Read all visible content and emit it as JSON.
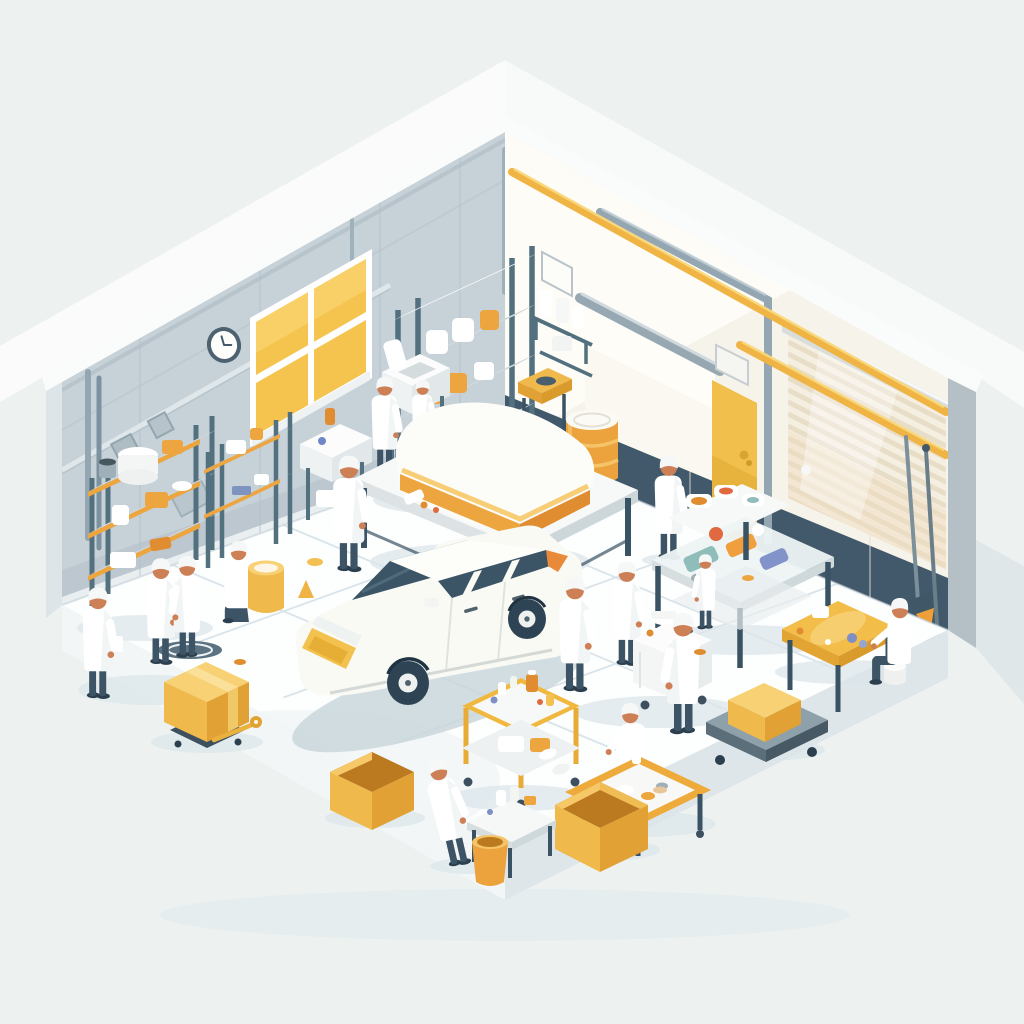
{
  "scene": {
    "description": "Isometric illustration of a bright workshop garage: staff in white coats and caps work around a white station wagon among yellow crates, barrels, part trays, shelving racks and rolling carts",
    "room": {
      "left_wall": "panelled gray-blue wall with round clock, yellow four-pane window, vertical pipes and diamond vents",
      "right_wall": "cream wall with yellow service pipes, yellow personnel door, white roller screen, striped roller shutter, dark teal wainscot and leaning shovels",
      "floor": "white tiled slab on an isometric plinth"
    },
    "objects": [
      "white-station-wagon",
      "left-supply-shelves",
      "tall-storage-rack",
      "wash-station",
      "rinse-counter",
      "orange-barrel",
      "orange-buckets",
      "yellow-drum",
      "closed-yellow-crate",
      "open-part-boxes",
      "tool-cart",
      "tray-table",
      "parts-worktable",
      "yellow-assembly-table",
      "white-service-cart",
      "platform-trolley",
      "jug-shelf",
      "scale-bench",
      "floor-mallet",
      "leaning-shovels",
      "wall-clock",
      "yellow-window"
    ],
    "worker_count": 15
  },
  "palette": {
    "bg": "#edf2f1",
    "glow": "#fbfdfc",
    "wallLeft": "#c7d1d8",
    "wallLeftDark": "#b2bfc8",
    "baseboard": "#e9eef0",
    "capWhite": "#fafcfc",
    "wallRight": "#f5f3ea",
    "wallRightBright": "#fefdf9",
    "wainscot": "#41596a",
    "pillar": "#b4bfc6",
    "windowYellow": "#f5c44f",
    "windowYellowLight": "#f9d36d",
    "pipeYellow": "#f0b445",
    "pipeYellowHi": "#f8d97e",
    "pipeGray": "#93a6b1",
    "doorYellow": "#f1c04c",
    "doorYellowDeep": "#e6b03a",
    "shutterBase": "#f5efe1",
    "shutterLine": "#e7dcc6",
    "shutterWarm": "#f0dcbd",
    "housing": "#d9dddb",
    "floorWhite": "#fdfefe",
    "tileLine": "#d5e1e8",
    "slabLeft": "#f2f6f6",
    "slabRight": "#dee6e9",
    "shadow": "#dce6eb",
    "shadowDark": "#c7d4da",
    "metal": "#53707f",
    "metalDark": "#3a5364",
    "metalLight": "#7d95a2",
    "shelfOrange": "#eda53f",
    "orangeDeep": "#e08c31",
    "innerOrange": "#bb7a20",
    "boxYellow": "#f0b94b",
    "boxYellowTop": "#f7d173",
    "boxYellowSide": "#e2a135",
    "barrelOrange": "#eca23d",
    "barrelHi": "#f5c468",
    "lidWhite": "#fbfaf5",
    "coat": "#ffffff",
    "coatShade": "#e7ecec",
    "skin": "#cd7f55",
    "pants": "#3c5465",
    "capHat": "#f6f8f8",
    "carBody": "#fafaf5",
    "carShade": "#e8eae4",
    "glass": "#3b5566",
    "tire": "#2e4455",
    "rim": "#eef1f0",
    "grille": "#f2c14e",
    "trayTeal": "#8fbdb9",
    "trayBlue": "#8293c9",
    "trayRed": "#e0693f",
    "trayOrange": "#ef9f3e",
    "cartWhite": "#f4f6f5"
  },
  "workers": [
    {
      "x": 97,
      "y": 697,
      "s": 0.92,
      "pose": "stand",
      "layer": "back"
    },
    {
      "x": 160,
      "y": 663,
      "s": 0.88,
      "pose": "stand",
      "layer": "back"
    },
    {
      "x": 188,
      "y": 656,
      "s": 0.84,
      "pose": "stand",
      "layer": "back",
      "flip": true
    },
    {
      "x": 236,
      "y": 622,
      "s": 0.86,
      "pose": "kneel",
      "layer": "back"
    },
    {
      "x": 384,
      "y": 472,
      "s": 0.8,
      "pose": "stand",
      "layer": "back"
    },
    {
      "x": 422,
      "y": 456,
      "s": 0.64,
      "pose": "stand",
      "layer": "back"
    },
    {
      "x": 348,
      "y": 570,
      "s": 0.96,
      "pose": "stand",
      "layer": "mid"
    },
    {
      "x": 668,
      "y": 558,
      "s": 0.86,
      "pose": "stand",
      "layer": "mid"
    },
    {
      "x": 626,
      "y": 664,
      "s": 0.86,
      "pose": "stand",
      "layer": "mid"
    },
    {
      "x": 574,
      "y": 690,
      "s": 0.95,
      "pose": "stand",
      "layer": "carfront"
    },
    {
      "x": 706,
      "y": 628,
      "s": 0.62,
      "pose": "stand",
      "layer": "tables",
      "flip": true
    },
    {
      "x": 684,
      "y": 732,
      "s": 1.0,
      "pose": "stand",
      "layer": "front",
      "flip": true
    },
    {
      "x": 900,
      "y": 683,
      "s": 0.9,
      "pose": "sit",
      "layer": "front",
      "flip": true
    },
    {
      "x": 633,
      "y": 788,
      "s": 0.9,
      "pose": "kneel",
      "layer": "front",
      "flip": true
    },
    {
      "x": 459,
      "y": 864,
      "s": 0.9,
      "pose": "stand",
      "layer": "front",
      "tilt": -13
    }
  ]
}
